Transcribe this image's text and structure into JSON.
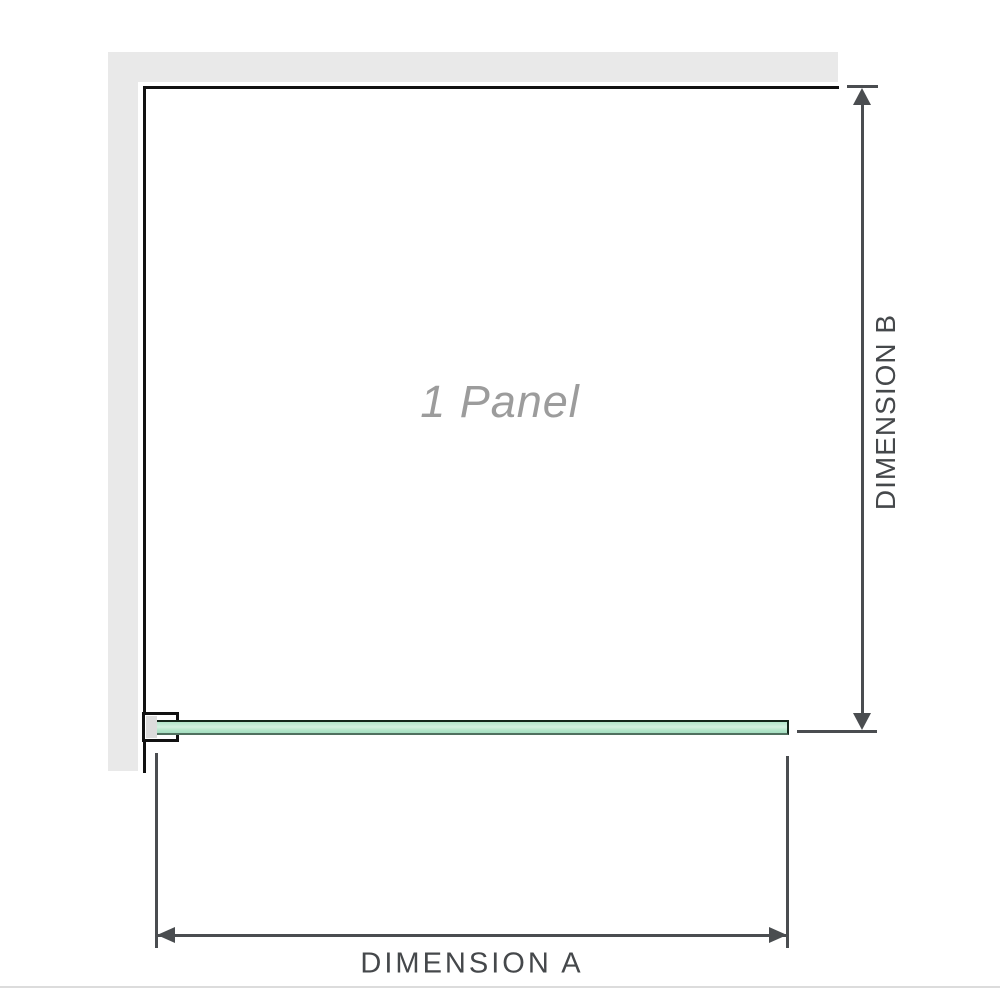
{
  "diagram": {
    "title": "Shower screen single panel dimension diagram",
    "panel_label": "1 Panel",
    "dimension_a_label": "DIMENSION A",
    "dimension_b_label": "DIMENSION B"
  },
  "colors": {
    "wall": "#e9e9e9",
    "outline": "#111111",
    "dimension": "#4a4d50",
    "glass_fill": "#b2e4c9",
    "glass_highlight": "#d3f0e0",
    "glass_border_top": "#13241a",
    "glass_border_bottom": "#50705f",
    "panel_label_text": "#9c9c9c",
    "dim_label_text": "#45484b",
    "bracket_shade": "#dcdcdc",
    "divider": "#dcdcdc"
  }
}
